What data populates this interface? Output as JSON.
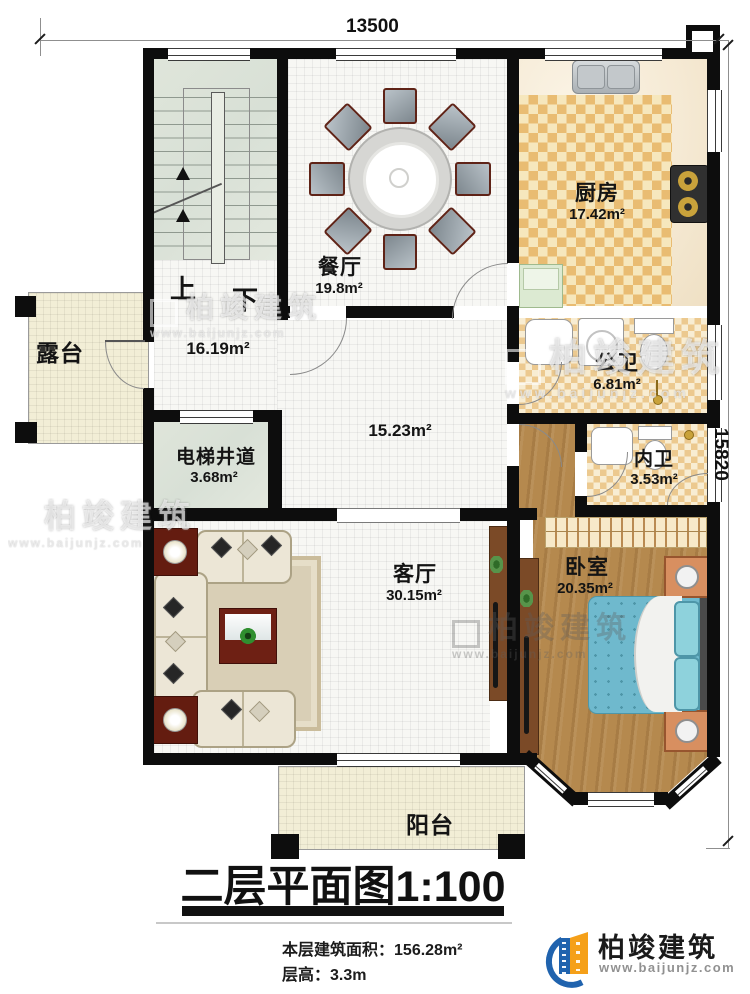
{
  "dimensions": {
    "width_label": "13500",
    "height_label": "15820"
  },
  "rooms": {
    "dining": {
      "name": "餐厅",
      "area": "19.8m²"
    },
    "kitchen": {
      "name": "厨房",
      "area": "17.42m²"
    },
    "public_bath": {
      "name": "公卫",
      "area": "6.81m²"
    },
    "ensuite_bath": {
      "name": "内卫",
      "area": "3.53m²"
    },
    "bedroom": {
      "name": "卧室",
      "area": "20.35m²"
    },
    "living": {
      "name": "客厅",
      "area": "30.15m²"
    },
    "elevator": {
      "name": "电梯井道",
      "area": "3.68m²"
    },
    "stair_hall": {
      "area": "16.19m²"
    },
    "hall": {
      "area": "15.23m²"
    },
    "terrace": {
      "name": "露台"
    },
    "balcony": {
      "name": "阳台"
    }
  },
  "stairs": {
    "up": "上",
    "down": "下"
  },
  "title": {
    "text": "二层平面图",
    "scale": "1:100"
  },
  "info": {
    "area_label": "本层建筑面积：",
    "area_value": "156.28m²",
    "height_label": "层高：",
    "height_value": "3.3m"
  },
  "brand": {
    "name": "柏竣建筑",
    "url": "www.baijunjz.com"
  },
  "watermark": {
    "name": "柏竣建筑",
    "url": "www.baijunjz.com"
  },
  "colors": {
    "wall": "#0d0d0d",
    "wood_floor": "#b5894e",
    "bed": "#6fb9cd",
    "brand_blue": "#2063ae",
    "brand_orange": "#f5a019"
  }
}
